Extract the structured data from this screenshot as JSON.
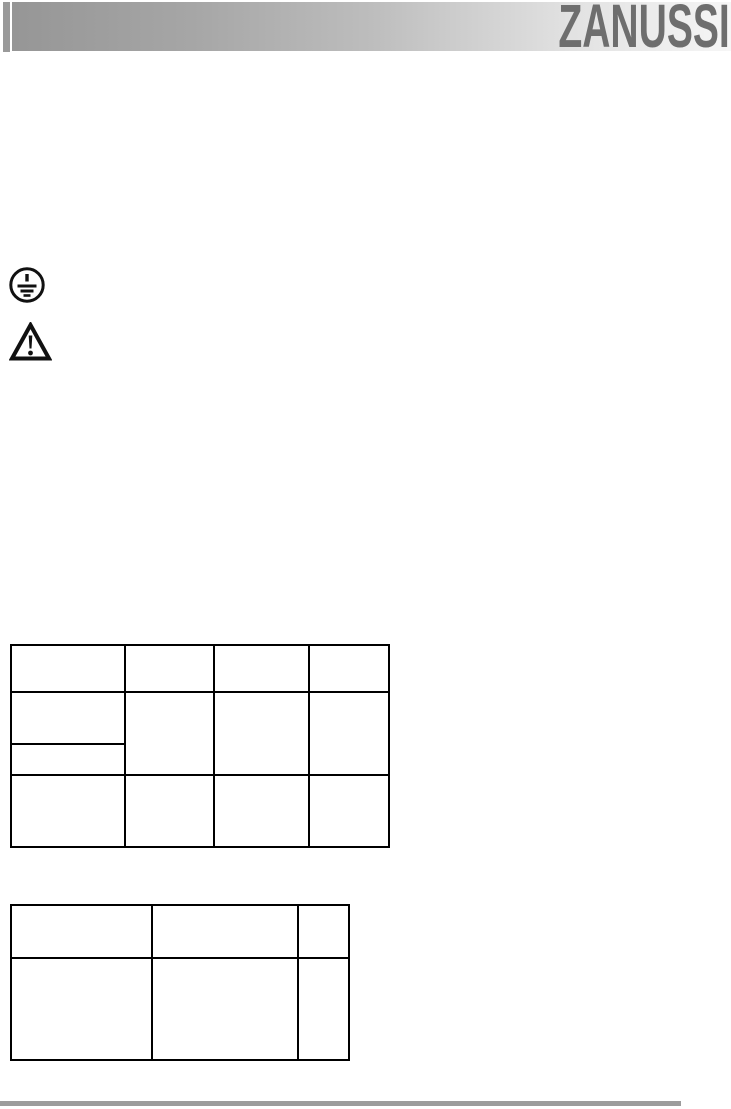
{
  "header": {
    "brand": "ZANUSSI",
    "brand_color": "#6e6e6e",
    "bar_gradient_start": "#969696",
    "bar_gradient_end": "#f6f6f6",
    "accent_bar_color": "#9a9a9a"
  },
  "symbols": [
    {
      "icon": "earth-ground-icon",
      "meaning": "protective earth (grounding) symbol"
    },
    {
      "icon": "warning-triangle-icon",
      "meaning": "warning exclamation triangle"
    }
  ],
  "tables": {
    "table1": {
      "columns": 4,
      "rows": [
        [
          "",
          "",
          "",
          ""
        ],
        [
          "",
          "",
          "",
          ""
        ],
        [
          ""
        ],
        [
          "",
          "",
          "",
          ""
        ]
      ]
    },
    "table2": {
      "columns": 3,
      "rows": [
        [
          "",
          "",
          ""
        ],
        [
          "",
          "",
          ""
        ]
      ]
    }
  },
  "footer": {
    "rule_color": "#9c9c9c"
  }
}
